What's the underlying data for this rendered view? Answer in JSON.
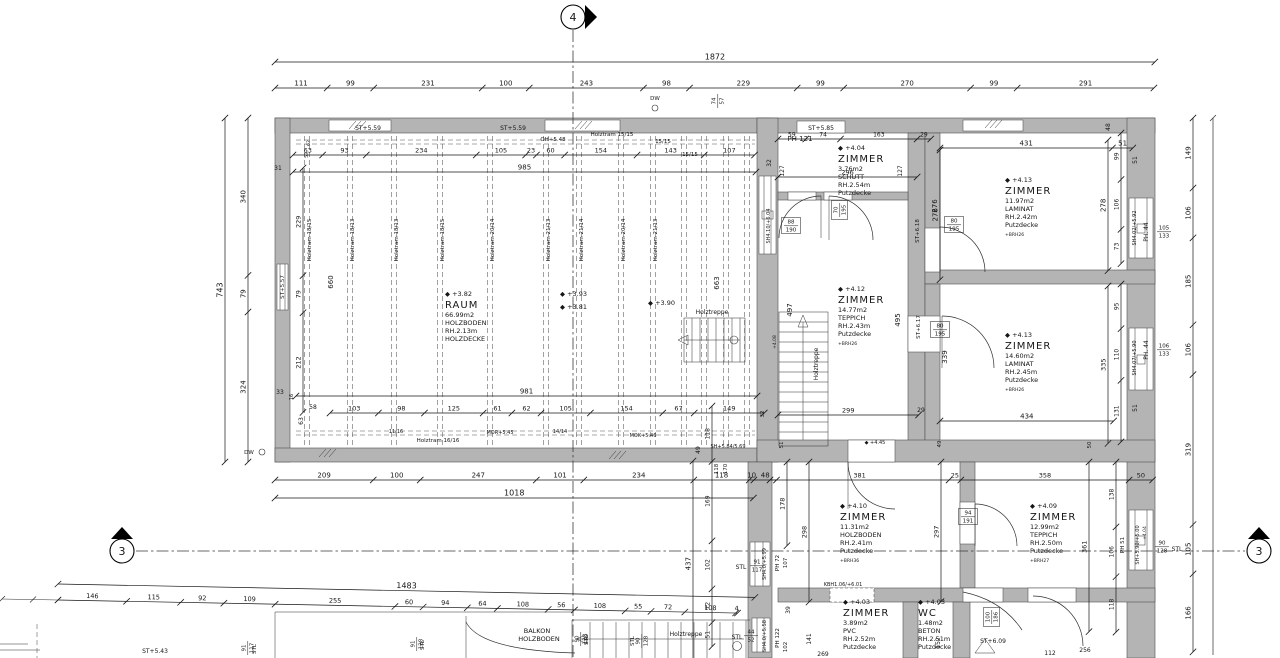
{
  "drawing": {
    "type": "floor-plan",
    "units": "cm"
  },
  "colors": {
    "wall": "#b4b4b4",
    "line": "#2e2e2e",
    "text": "#161616",
    "background": "#ffffff"
  },
  "section_markers": [
    {
      "id": "4",
      "x": 573,
      "y": 17,
      "tri": "585,5 597,17 585,29"
    },
    {
      "id": "3",
      "x": 122,
      "y": 551,
      "tri": "111,539 122,527 133,539"
    },
    {
      "id": "3",
      "x": 1259,
      "y": 551,
      "tri": "1248,539 1259,527 1270,539"
    }
  ],
  "dim_chains": [
    {
      "o": "h",
      "x": 275,
      "y": 62,
      "s": 0.47,
      "v": [
        1872
      ],
      "fs": 8
    },
    {
      "o": "h",
      "x": 275,
      "y": 88,
      "s": 0.47,
      "v": [
        111,
        99,
        231,
        100,
        243,
        98,
        229,
        99,
        270,
        99,
        291
      ],
      "fs": 7
    },
    {
      "o": "v",
      "x": 225,
      "y": 118,
      "s": 0.463,
      "v": [
        743
      ],
      "fs": 8
    },
    {
      "o": "v",
      "x": 248,
      "y": 118,
      "s": 0.463,
      "v": [
        340,
        79,
        324
      ],
      "fs": 7
    },
    {
      "o": "v",
      "x": 1193,
      "y": 118,
      "s": 0.47,
      "v": [
        149,
        106,
        185,
        106,
        319,
        105,
        166
      ],
      "fs": 7
    },
    {
      "o": "h",
      "x": 293,
      "y": 172,
      "s": 0.47,
      "v": [
        985
      ],
      "fs": 7
    },
    {
      "o": "h",
      "x": 293,
      "y": 155,
      "s": 0.47,
      "v": [
        63,
        93,
        234,
        105,
        23,
        60,
        154,
        143,
        107
      ],
      "fs": 6.5
    },
    {
      "o": "h",
      "x": 296,
      "y": 396,
      "s": 0.47,
      "v": [
        981
      ],
      "fs": 7
    },
    {
      "o": "h",
      "x": 330,
      "y": 413,
      "s": 0.47,
      "v": [
        103,
        98,
        125,
        61,
        62,
        105,
        154,
        67,
        149
      ],
      "fs": 6.5
    },
    {
      "o": "h",
      "x": 275,
      "y": 480,
      "s": 0.47,
      "v": [
        209,
        100,
        247,
        101,
        234,
        118,
        10,
        48
      ],
      "fs": 7
    },
    {
      "o": "h",
      "x": 275,
      "y": 498,
      "s": 0.47,
      "v": [
        1018
      ],
      "fs": 8
    },
    {
      "o": "h",
      "x": 58,
      "y": 600,
      "s": 0.47,
      "rot": 1.1,
      "v": [
        146,
        115,
        92,
        109,
        255,
        60,
        94,
        64,
        108,
        56,
        108,
        55,
        72,
        108,
        4
      ],
      "fs": 6.5
    },
    {
      "o": "h",
      "x": 58,
      "y": 584,
      "s": 0.47,
      "rot": 1.1,
      "v": [
        1483
      ],
      "fs": 8
    },
    {
      "o": "v",
      "x": 712,
      "y": 406,
      "s": 0.47,
      "v": [
        118,
        169,
        102,
        72,
        51
      ],
      "fs": 6
    },
    {
      "o": "v",
      "x": 693,
      "y": 461,
      "s": 0.47,
      "v": [
        437
      ],
      "fs": 7
    },
    {
      "o": "v",
      "x": 1121,
      "y": 133,
      "s": 0.47,
      "v": [
        99,
        106,
        73
      ],
      "fs": 6
    },
    {
      "o": "v",
      "x": 1121,
      "y": 284,
      "s": 0.47,
      "v": [
        95,
        110,
        131
      ],
      "fs": 6
    },
    {
      "o": "v",
      "x": 1108,
      "y": 140,
      "s": 0.47,
      "v": [
        278
      ],
      "fs": 7
    },
    {
      "o": "v",
      "x": 1108,
      "y": 286,
      "s": 0.47,
      "v": [
        335
      ],
      "fs": 6.5
    },
    {
      "o": "v",
      "x": 940,
      "y": 150,
      "s": 0.47,
      "v": [
        276
      ],
      "fs": 7
    },
    {
      "o": "v",
      "x": 303,
      "y": 168,
      "s": 0.47,
      "v": [
        229,
        79,
        212
      ],
      "fs": 6.5
    },
    {
      "o": "v",
      "x": 787,
      "y": 462,
      "s": 0.47,
      "v": [
        178
      ],
      "fs": 6.5
    },
    {
      "o": "v",
      "x": 809,
      "y": 462,
      "s": 0.47,
      "v": [
        298
      ],
      "fs": 6.5
    },
    {
      "o": "v",
      "x": 941,
      "y": 462,
      "s": 0.47,
      "v": [
        297
      ],
      "fs": 6.5
    },
    {
      "o": "v",
      "x": 1089,
      "y": 462,
      "s": 0.47,
      "v": [
        361
      ],
      "fs": 6.5
    },
    {
      "o": "v",
      "x": 1116,
      "y": 462,
      "s": 0.47,
      "v": [
        138,
        106,
        118
      ],
      "fs": 6
    },
    {
      "o": "h",
      "x": 770,
      "y": 480,
      "s": 0.47,
      "v": [
        381,
        25,
        358,
        50
      ],
      "fs": 6.5
    },
    {
      "o": "h",
      "x": 778,
      "y": 139,
      "s": 0.47,
      "v": [
        59,
        74,
        163,
        29
      ],
      "fs": 6
    },
    {
      "o": "h",
      "x": 778,
      "y": 177,
      "s": 0.47,
      "v": [
        296
      ],
      "fs": 6.5
    },
    {
      "o": "h",
      "x": 940,
      "y": 148,
      "s": 0.4,
      "v": [
        431,
        51
      ],
      "fs": 7
    },
    {
      "o": "h",
      "x": 940,
      "y": 421,
      "s": 0.4,
      "v": [
        434
      ],
      "fs": 7
    },
    {
      "o": "h",
      "x": 778,
      "y": 415,
      "s": 0.47,
      "v": [
        299
      ],
      "fs": 6.5
    }
  ],
  "beams": [
    {
      "x": 307,
      "l": "Holztram 18/15"
    },
    {
      "x": 350,
      "l": "Holztram 18/13"
    },
    {
      "x": 394,
      "l": "Holztram 18/13"
    },
    {
      "x": 440,
      "l": "Holztram 18/15"
    },
    {
      "x": 490,
      "l": "Holztram 20/14"
    },
    {
      "x": 546,
      "l": "Holztram 21/13"
    },
    {
      "x": 579,
      "l": "Holztram 21/14"
    },
    {
      "x": 621,
      "l": "Holztram 20/14"
    },
    {
      "x": 653,
      "l": "Holztram 21/13"
    },
    {
      "x": 684
    },
    {
      "x": 704
    },
    {
      "x": 726
    },
    {
      "x": 747
    }
  ],
  "rooms": [
    {
      "x": 445,
      "y": 296,
      "lines": [
        "+3.82",
        "RAUM",
        "66.99m2",
        "HOLZBODEN",
        "RH.2.13m",
        "HOLZDECKE"
      ]
    },
    {
      "x": 838,
      "y": 150,
      "lines": [
        "+4.04",
        "ZIMMER",
        "3.76m2",
        "SCHUTT",
        "RH.2.54m",
        "Putzdecke"
      ]
    },
    {
      "x": 1005,
      "y": 182,
      "lines": [
        "+4.13",
        "ZIMMER",
        "11.97m2",
        "LAMINAT",
        "RH.2.42m",
        "Putzdecke",
        "+BRH26"
      ]
    },
    {
      "x": 838,
      "y": 291,
      "lines": [
        "+4.12",
        "ZIMMER",
        "14.77m2",
        "TEPPICH",
        "RH.2.43m",
        "Putzdecke",
        "+BRH26"
      ]
    },
    {
      "x": 1005,
      "y": 337,
      "lines": [
        "+4.13",
        "ZIMMER",
        "14.60m2",
        "LAMINAT",
        "RH.2.45m",
        "Putzdecke",
        "+BRH26"
      ]
    },
    {
      "x": 840,
      "y": 508,
      "lines": [
        "+4.10",
        "ZIMMER",
        "11.31m2",
        "HOLZBODEN",
        "RH.2.41m",
        "Putzdecke",
        "+BRH36"
      ]
    },
    {
      "x": 1030,
      "y": 508,
      "lines": [
        "+4.09",
        "ZIMMER",
        "12.99m2",
        "TEPPICH",
        "RH.2.50m",
        "Putzdecke",
        "+BRH27"
      ]
    },
    {
      "x": 843,
      "y": 604,
      "lines": [
        "+4.03",
        "ZIMMER",
        "3.89m2",
        "PVC",
        "RH.2.52m",
        "Putzdecke"
      ]
    },
    {
      "x": 918,
      "y": 604,
      "lines": [
        "+4.03",
        "WC",
        "1.48m2",
        "BETON",
        "RH.2.51m",
        "Putzdecke"
      ]
    }
  ],
  "labels": [
    {
      "t": "ST+5.59",
      "x": 368,
      "y": 130,
      "fs": 6
    },
    {
      "t": "ST+5.59",
      "x": 513,
      "y": 130,
      "fs": 6
    },
    {
      "t": "OH+5.48",
      "x": 553,
      "y": 141,
      "fs": 5.5
    },
    {
      "t": "Holztram 15/15",
      "x": 612,
      "y": 136,
      "fs": 5.5
    },
    {
      "t": "15/15",
      "x": 663,
      "y": 143,
      "fs": 5.5
    },
    {
      "t": "15/15",
      "x": 690,
      "y": 156,
      "fs": 5.5
    },
    {
      "t": "Holztram 16/16",
      "x": 438,
      "y": 442,
      "fs": 5.5
    },
    {
      "t": "ST+5.85",
      "x": 821,
      "y": 130,
      "fs": 6
    },
    {
      "t": "PH 121",
      "x": 800,
      "y": 141,
      "fs": 7
    },
    {
      "t": "ST+5.57",
      "x": 284,
      "y": 287,
      "r": -90,
      "fs": 5.5
    },
    {
      "t": "DW",
      "x": 655,
      "y": 100,
      "fs": 5.5
    },
    {
      "t": "DW",
      "x": 249,
      "y": 454,
      "fs": 5.5
    },
    {
      "t": "62",
      "x": 310,
      "y": 143,
      "r": -90,
      "fs": 4.5
    },
    {
      "t": "53",
      "x": 308,
      "y": 155,
      "r": -90,
      "fs": 4.5
    },
    {
      "t": "31",
      "x": 278,
      "y": 170,
      "fs": 6
    },
    {
      "t": "660",
      "x": 333,
      "y": 282,
      "r": -90,
      "fs": 7
    },
    {
      "t": "33",
      "x": 280,
      "y": 394,
      "fs": 6
    },
    {
      "t": "16",
      "x": 293,
      "y": 397,
      "r": -90,
      "fs": 5
    },
    {
      "t": "58",
      "x": 313,
      "y": 409,
      "fs": 6
    },
    {
      "t": "63",
      "x": 303,
      "y": 421,
      "r": -90,
      "fs": 6
    },
    {
      "t": "32",
      "x": 764,
      "y": 414,
      "r": -90,
      "fs": 5.5
    },
    {
      "t": "29",
      "x": 921,
      "y": 412,
      "fs": 6
    },
    {
      "t": "32",
      "x": 771,
      "y": 163,
      "r": -90,
      "fs": 6
    },
    {
      "t": "127",
      "x": 784,
      "y": 171,
      "r": -90,
      "fs": 6
    },
    {
      "t": "127",
      "x": 902,
      "y": 171,
      "r": -90,
      "fs": 6
    },
    {
      "t": "+3.93",
      "x": 560,
      "y": 296,
      "lv": true,
      "fs": 6.5,
      "a": "start",
      "x2": 0
    },
    {
      "t": "+3.81",
      "x": 560,
      "y": 309,
      "lv": true,
      "fs": 6.5,
      "a": "start"
    },
    {
      "t": "+3.90",
      "x": 648,
      "y": 305,
      "lv": true,
      "fs": 6.5,
      "a": "start"
    },
    {
      "t": "Holztreppe",
      "x": 712,
      "y": 314,
      "fs": 6
    },
    {
      "t": "663",
      "x": 719,
      "y": 283,
      "r": -90,
      "fs": 7
    },
    {
      "t": "Holztreppe",
      "x": 818,
      "y": 364,
      "r": -90,
      "fs": 6
    },
    {
      "t": "+4.08",
      "x": 776,
      "y": 342,
      "r": -90,
      "fs": 4.5
    },
    {
      "t": "11/16",
      "x": 396,
      "y": 433,
      "fs": 5
    },
    {
      "t": "MOR+5.45",
      "x": 500,
      "y": 434,
      "fs": 5
    },
    {
      "t": "14/14",
      "x": 560,
      "y": 433,
      "fs": 5
    },
    {
      "t": "MOK+5.46",
      "x": 643,
      "y": 437,
      "fs": 5
    },
    {
      "t": "SH+5.84/5.69",
      "x": 728,
      "y": 448,
      "fs": 5
    },
    {
      "t": "49",
      "x": 700,
      "y": 450,
      "r": -90,
      "fs": 6
    },
    {
      "t": "118",
      "x": 718,
      "y": 469,
      "r": -90,
      "fs": 5.5
    },
    {
      "t": "170",
      "x": 727,
      "y": 469,
      "r": -90,
      "fs": 5.5
    },
    {
      "t": "497",
      "x": 792,
      "y": 310,
      "r": -90,
      "fs": 7
    },
    {
      "t": "495",
      "x": 900,
      "y": 320,
      "r": -90,
      "fs": 7
    },
    {
      "t": "ST+6.17",
      "x": 920,
      "y": 327,
      "r": -90,
      "fs": 5.5
    },
    {
      "t": "339",
      "x": 947,
      "y": 357,
      "r": -90,
      "fs": 7
    },
    {
      "t": "276",
      "x": 937,
      "y": 206,
      "r": -90,
      "fs": 7
    },
    {
      "t": "ST+6.18",
      "x": 919,
      "y": 231,
      "r": -90,
      "fs": 5.5
    },
    {
      "t": "SH4.10/+6.04",
      "x": 770,
      "y": 226,
      "r": -90,
      "fs": 5
    },
    {
      "t": "48",
      "x": 1110,
      "y": 127,
      "r": -90,
      "fs": 6
    },
    {
      "t": "51",
      "x": 1137,
      "y": 160,
      "r": -90,
      "fs": 6
    },
    {
      "t": "51",
      "x": 1137,
      "y": 408,
      "r": -90,
      "fs": 6
    },
    {
      "t": "PH. 44",
      "x": 1148,
      "y": 232,
      "r": -90,
      "fs": 6
    },
    {
      "t": "SH4.02/+5.92",
      "x": 1136,
      "y": 228,
      "r": -90,
      "fs": 5
    },
    {
      "t": "PH. 44",
      "x": 1148,
      "y": 350,
      "r": -90,
      "fs": 6
    },
    {
      "t": "SH4.07/+5.90",
      "x": 1136,
      "y": 358,
      "r": -90,
      "fs": 5
    },
    {
      "t": "+4.04",
      "x": 1146,
      "y": 533,
      "r": -90,
      "fs": 4.5
    },
    {
      "t": "51",
      "x": 783,
      "y": 445,
      "r": -90,
      "fs": 5.5
    },
    {
      "t": "+4.45",
      "x": 875,
      "y": 444,
      "lv": true,
      "fs": 5
    },
    {
      "t": "49",
      "x": 941,
      "y": 444,
      "r": -90,
      "fs": 5.5
    },
    {
      "t": "50",
      "x": 1091,
      "y": 445,
      "r": -90,
      "fs": 5.5
    },
    {
      "t": "KBH1.06/+6.01",
      "x": 843,
      "y": 586,
      "fs": 5
    },
    {
      "t": "PH 51",
      "x": 1124,
      "y": 545,
      "r": -90,
      "fs": 5.5
    },
    {
      "t": "SH+5.90/+5.00",
      "x": 1139,
      "y": 545,
      "r": -90,
      "fs": 5
    },
    {
      "t": "STL",
      "x": 1177,
      "y": 551,
      "fs": 6
    },
    {
      "t": "STL",
      "x": 741,
      "y": 569,
      "fs": 6
    },
    {
      "t": "SH4.0/+5.99",
      "x": 766,
      "y": 564,
      "r": -90,
      "fs": 5
    },
    {
      "t": "PH 72",
      "x": 779,
      "y": 563,
      "r": -90,
      "fs": 5.5
    },
    {
      "t": "107",
      "x": 787,
      "y": 563,
      "r": -90,
      "fs": 5.5
    },
    {
      "t": "STL",
      "x": 737,
      "y": 639,
      "fs": 6
    },
    {
      "t": "SH4.0/+5.58",
      "x": 766,
      "y": 636,
      "r": -90,
      "fs": 5
    },
    {
      "t": "PH 122",
      "x": 779,
      "y": 638,
      "r": -90,
      "fs": 5.5
    },
    {
      "t": "102",
      "x": 787,
      "y": 647,
      "r": -90,
      "fs": 5.5
    },
    {
      "t": "39",
      "x": 790,
      "y": 610,
      "r": -90,
      "fs": 6
    },
    {
      "t": "141",
      "x": 811,
      "y": 639,
      "r": -90,
      "fs": 6
    },
    {
      "t": "269",
      "x": 823,
      "y": 656,
      "fs": 6
    },
    {
      "t": "152",
      "x": 940,
      "y": 643,
      "r": -90,
      "fs": 6
    },
    {
      "t": "ST+6.09",
      "x": 993,
      "y": 643,
      "fs": 6
    },
    {
      "t": "112",
      "x": 1050,
      "y": 655,
      "fs": 6
    },
    {
      "t": "256",
      "x": 1085,
      "y": 652,
      "fs": 6
    },
    {
      "t": "BALKON",
      "x": 537,
      "y": 633,
      "fs": 6.5
    },
    {
      "t": "HOLZBODEN",
      "x": 539,
      "y": 641,
      "fs": 6.5
    },
    {
      "t": "Holztreppe",
      "x": 686,
      "y": 636,
      "fs": 6
    },
    {
      "t": "STL",
      "x": 424,
      "y": 645,
      "r": -90,
      "fs": 5.5
    },
    {
      "t": "STL",
      "x": 588,
      "y": 640,
      "r": -90,
      "fs": 5.5
    },
    {
      "t": "STL",
      "x": 634,
      "y": 641,
      "r": -90,
      "fs": 5.5
    },
    {
      "t": "STL",
      "x": 256,
      "y": 649,
      "r": -90,
      "fs": 5.5
    },
    {
      "t": "ST+5.43",
      "x": 155,
      "y": 653,
      "fs": 6
    }
  ],
  "fracs": [
    {
      "t": "74",
      "b": "57",
      "x": 717,
      "y": 101,
      "r": -90
    },
    {
      "t": "105",
      "b": "133",
      "x": 1164,
      "y": 231
    },
    {
      "t": "106",
      "b": "133",
      "x": 1164,
      "y": 349
    },
    {
      "t": "80",
      "b": "195",
      "x": 940,
      "y": 329,
      "box": true
    },
    {
      "t": "80",
      "b": "195",
      "x": 954,
      "y": 224,
      "box": true
    },
    {
      "t": "88",
      "b": "190",
      "x": 791,
      "y": 225,
      "box": true
    },
    {
      "t": "70",
      "b": "195",
      "x": 839,
      "y": 210,
      "r": -90,
      "box": true
    },
    {
      "t": "94",
      "b": "191",
      "x": 968,
      "y": 516,
      "box": true
    },
    {
      "t": "91",
      "b": "117",
      "x": 757,
      "y": 565
    },
    {
      "t": "44",
      "b": "52",
      "x": 751,
      "y": 635
    },
    {
      "t": "90",
      "b": "128",
      "x": 1162,
      "y": 546
    },
    {
      "t": "100",
      "b": "186",
      "x": 991,
      "y": 617,
      "r": -90,
      "box": true
    },
    {
      "t": "91",
      "b": "128",
      "x": 416,
      "y": 644,
      "r": -90
    },
    {
      "t": "90",
      "b": "128",
      "x": 580,
      "y": 639,
      "r": -90
    },
    {
      "t": "90",
      "b": "128",
      "x": 641,
      "y": 641,
      "r": -90
    },
    {
      "t": "91",
      "b": "117",
      "x": 247,
      "y": 648,
      "r": -90
    }
  ]
}
